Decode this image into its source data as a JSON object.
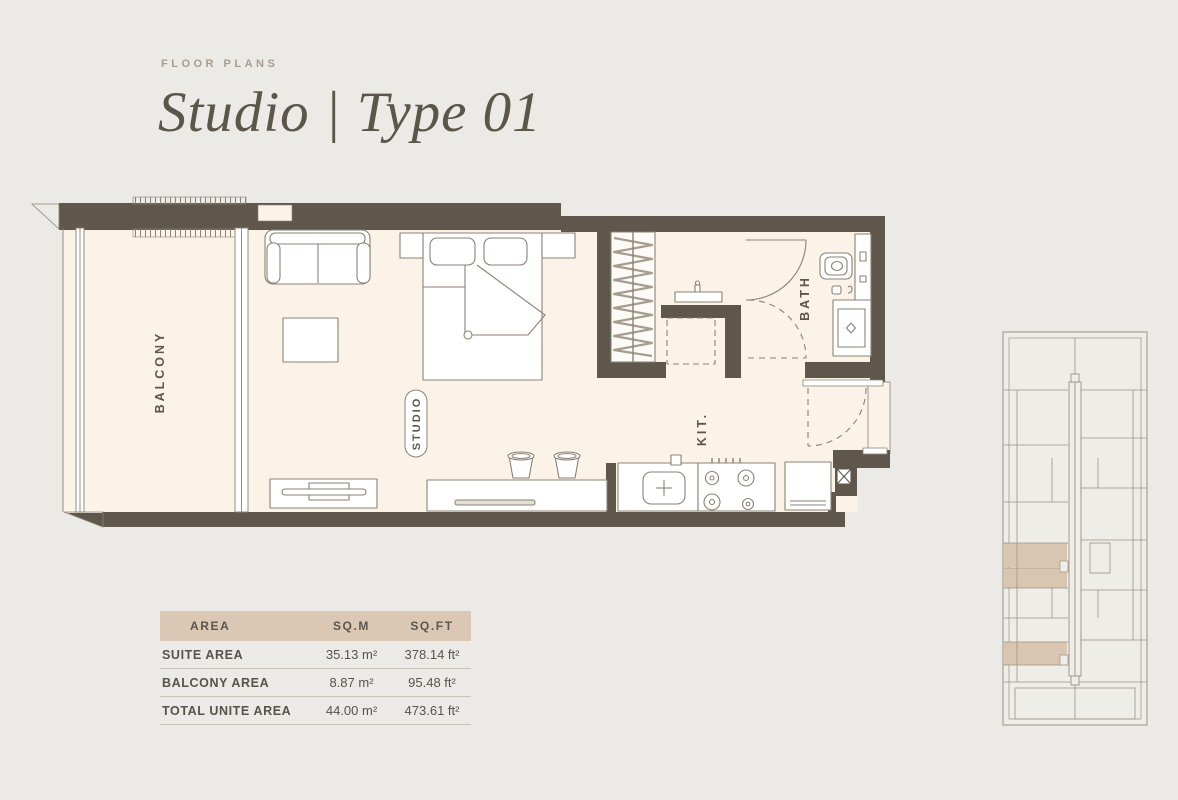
{
  "header": {
    "eyebrow": "FLOOR PLANS",
    "title": "Studio | Type 01"
  },
  "floorplan": {
    "labels": {
      "balcony": "BALCONY",
      "studio": "STUDIO",
      "bath": "BATH",
      "kitchen": "KIT."
    }
  },
  "area_table": {
    "columns": [
      "AREA",
      "SQ.M",
      "SQ.FT"
    ],
    "rows": [
      {
        "label": "SUITE AREA",
        "sqm": "35.13 m²",
        "sqft": "378.14 ft²"
      },
      {
        "label": "BALCONY AREA",
        "sqm": "8.87 m²",
        "sqft": "95.48 ft²"
      },
      {
        "label": "TOTAL UNITE AREA",
        "sqm": "44.00 m²",
        "sqft": "473.61 ft²"
      }
    ]
  },
  "colors": {
    "background": "#ECEAE6",
    "floor": "#FCF3E8",
    "wall": "#5F574C",
    "furniture_line": "#8B8275",
    "keyplan_line": "#9A9186",
    "highlight_tan": "#D9C6B1",
    "table_header_bg": "#DBC8B4",
    "text": "#57534B",
    "muted": "#A69C8F"
  }
}
